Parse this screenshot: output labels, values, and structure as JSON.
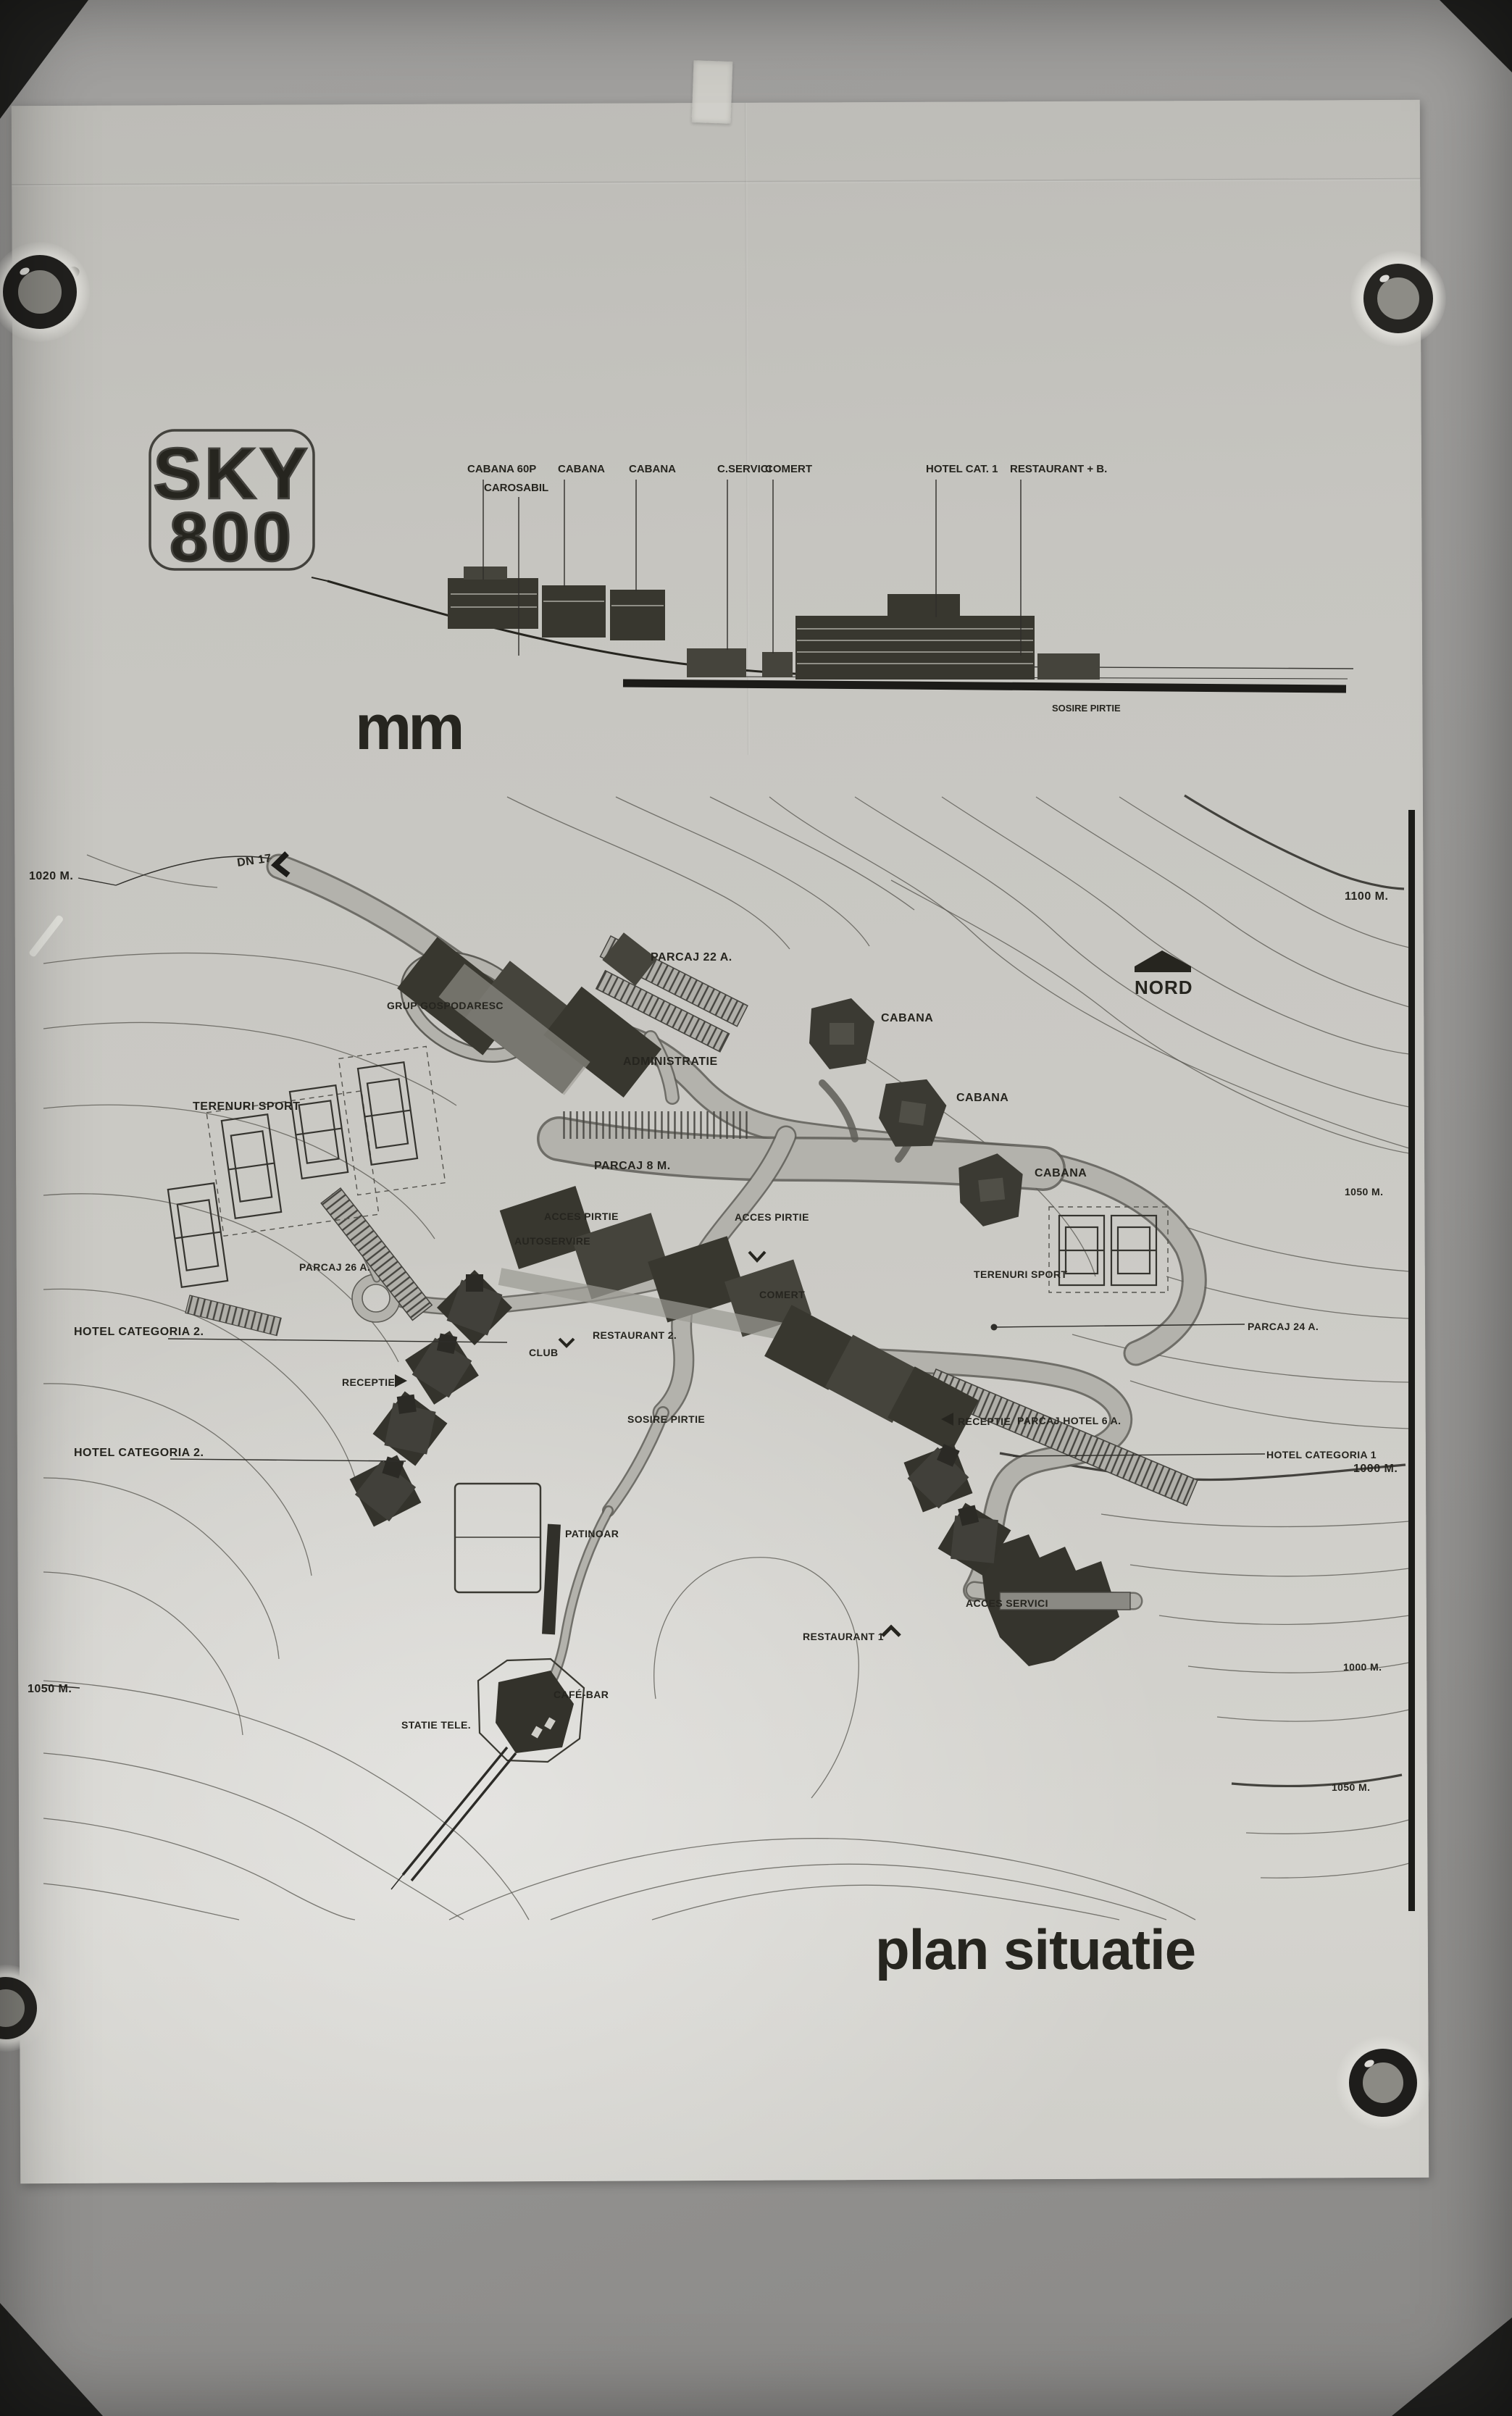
{
  "colors": {
    "ink": "#26251f",
    "paper": "#cbcac5",
    "wall": "#9b9a98",
    "building": "#38372f"
  },
  "logo": {
    "line1": "SKY",
    "line2": "800"
  },
  "stamp": "mm",
  "title": "plan situatie",
  "elevation": {
    "labels": [
      "CABANA 60P",
      "CAROSABIL",
      "CABANA",
      "CABANA",
      "C.SERVICI",
      "COMERT",
      "HOTEL CAT. 1",
      "RESTAURANT + B."
    ],
    "sublabel": "SOSIRE PIRTIE"
  },
  "plan": {
    "labels": {
      "dn17": "DN 17",
      "elev_left_top": "1020 M.",
      "elev_1100": "1100 M.",
      "parcaj22": "PARCAJ 22 A.",
      "grup": "GRUP GOSPODARESC",
      "administratie": "ADMINISTRATIE",
      "cabana1": "CABANA",
      "cabana2": "CABANA",
      "cabana3": "CABANA",
      "terenuri_left": "TERENURI SPORT",
      "parcaj26": "PARCAJ 26 A.",
      "parcaj8m": "PARCAJ 8 M.",
      "acces_left": "ACCES PIRTIE",
      "acces_right": "ACCES PIRTIE",
      "autoservire": "AUTOSERVIRE",
      "terenuri_right": "TERENURI SPORT",
      "parcaj24": "PARCAJ 24 A.",
      "comert": "COMERT",
      "restaurant2": "RESTAURANT 2.",
      "club": "CLUB",
      "hotel2_upper": "HOTEL CATEGORIA 2.",
      "receptie_left": "RECEPTIE",
      "hotel2_lower": "HOTEL CATEGORIA 2.",
      "sosire": "SOSIRE PIRTIE",
      "receptie_right": "RECEPTIE",
      "parcaj_hotel": "PARCAJ HOTEL 6 A.",
      "hotel1": "HOTEL CATEGORIA 1",
      "elev_1000_hotel": "1000 M.",
      "patinoar": "PATINOAR",
      "acces_servici": "ACCES SERVICI",
      "restaurant1": "RESTAURANT 1",
      "statie": "STATIE TELE.",
      "cafebar": "CAFÉ-BAR",
      "elev_1050_left": "1050 M.",
      "elev_1050_right": "1050 M.",
      "elev_1000_low": "1000 M.",
      "elev_1050_low": "1050 M.",
      "nord": "NORD"
    }
  }
}
